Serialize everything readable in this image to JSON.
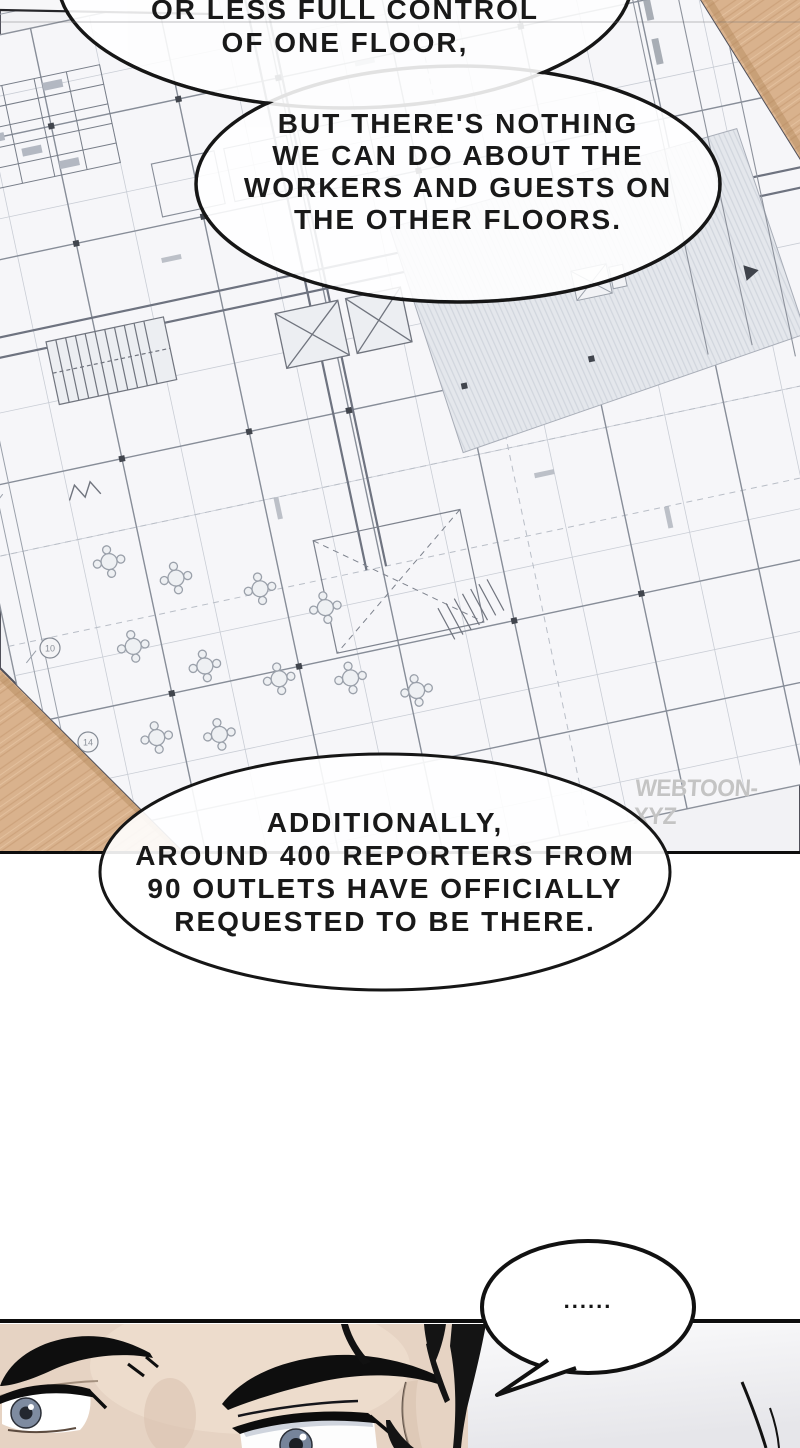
{
  "bubbles": {
    "top": {
      "lines": [
        "OR LESS FULL CONTROL",
        "OF ONE FLOOR,"
      ]
    },
    "second": {
      "lines": [
        "BUT THERE'S NOTHING",
        "WE CAN DO ABOUT THE",
        "WORKERS AND GUESTS ON",
        "THE OTHER FLOORS."
      ]
    },
    "third": {
      "lines": [
        "ADDITIONALLY,",
        "AROUND 400 REPORTERS FROM",
        "90 OUTLETS HAVE OFFICIALLY",
        "REQUESTED TO BE THERE."
      ]
    },
    "ellipsis": {
      "text": "......"
    }
  },
  "watermark": {
    "text": "WEBTOON-XYZ"
  },
  "blueprint": {
    "grid_labels": [
      "10",
      "14"
    ]
  },
  "colors": {
    "wood": "#d9b28d",
    "wood_grain": "#cda37c",
    "paper": "#f2f2f5",
    "plan_line": "#8d929c",
    "plan_wall": "#6e7380",
    "hatch_fill": "#e4e7ec",
    "ink": "#0d0d0d",
    "skin": "#e6d3c3",
    "iris": "#7e8ba0",
    "watermark_gray": "#bababa"
  }
}
